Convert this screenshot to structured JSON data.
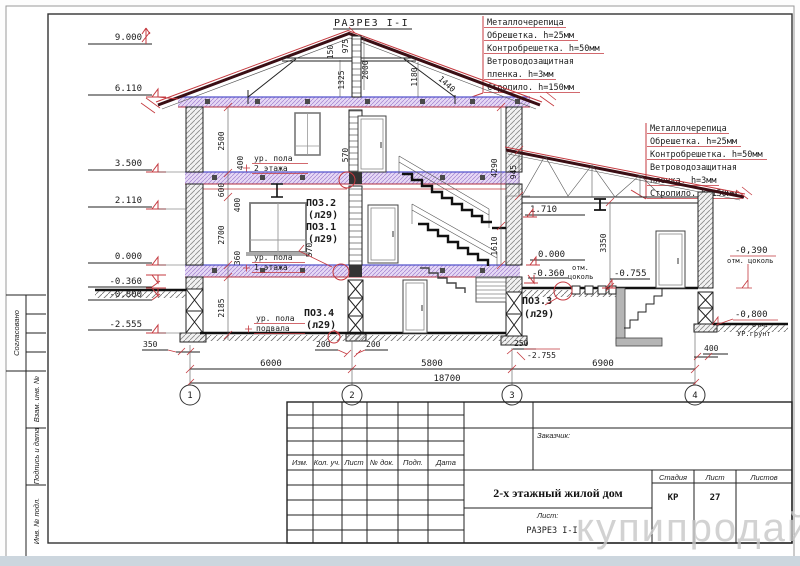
{
  "page": {
    "title": "РАЗРЕЗ I-I",
    "watermark": "купипродай"
  },
  "sidebar": [
    "Согласовано",
    "Взам. инв. №",
    "Подпись и дата",
    "Инв. № подл."
  ],
  "spec": {
    "lines": [
      "Металлочерепица",
      "Обрешетка. h=25мм",
      "Контробрешетка. h=50мм",
      "Ветроводозащитная",
      "пленка. h=3мм",
      "Стропило. h=150мм"
    ]
  },
  "levels_left": [
    "9.000",
    "6.110",
    "3.500",
    "2.110",
    "0.000",
    "-0.360",
    "-0.800",
    "-2.555"
  ],
  "levels_right": {
    "v1710": "1.710",
    "v0": "0.000",
    "vm360": "-0.360",
    "otm": "отм.",
    "cokol": "цоколь",
    "vm755": "-0.755",
    "vm390": "-0,390",
    "otm_cokol": "отм. цоколь",
    "vm800": "-0,800",
    "otm2": "отм.",
    "ugrunt": "УР.грунт"
  },
  "floors": {
    "line1": "ур. пола",
    "f2": "2 этажа",
    "f1": "1 этажа",
    "fb": "подвала"
  },
  "pos": {
    "p1": "ПОЗ.1",
    "p2": "ПОЗ.2",
    "p3": "ПОЗ.3",
    "p4": "ПОЗ.4",
    "ref": "(л29)"
  },
  "dims": {
    "r150": "150",
    "r975": "975",
    "r2000": "2000",
    "r1325": "1325",
    "r1180": "1180",
    "r1440": "1440",
    "w2500": "2500",
    "w600": "600",
    "w400a": "400",
    "w2700": "2700",
    "w360": "360",
    "w400b": "400",
    "w570a": "570",
    "w570b": "570",
    "w2185": "2185",
    "s4290": "4290",
    "s1610": "1610",
    "a945": "945",
    "a3350": "3350",
    "b350": "350",
    "b200a": "200",
    "b200b": "200",
    "b250": "250",
    "b400": "400",
    "b6000": "6000",
    "b5800": "5800",
    "b6900": "6900",
    "b18700": "18700",
    "bpit": "-2.755"
  },
  "axes": [
    "1",
    "2",
    "3",
    "4"
  ],
  "stamp": {
    "cols": [
      "Изм.",
      "Кол. уч.",
      "Лист",
      "№ док.",
      "Подп.",
      "Дата"
    ],
    "customer": "Заказчик:",
    "title": "2-х этажный жилой дом",
    "stage_h": "Стадия",
    "sheet_h": "Лист",
    "sheets_h": "Листов",
    "stage": "КР",
    "sheet": "27",
    "list_label": "Лист:",
    "drawing": "РАЗРЕЗ I-I"
  }
}
